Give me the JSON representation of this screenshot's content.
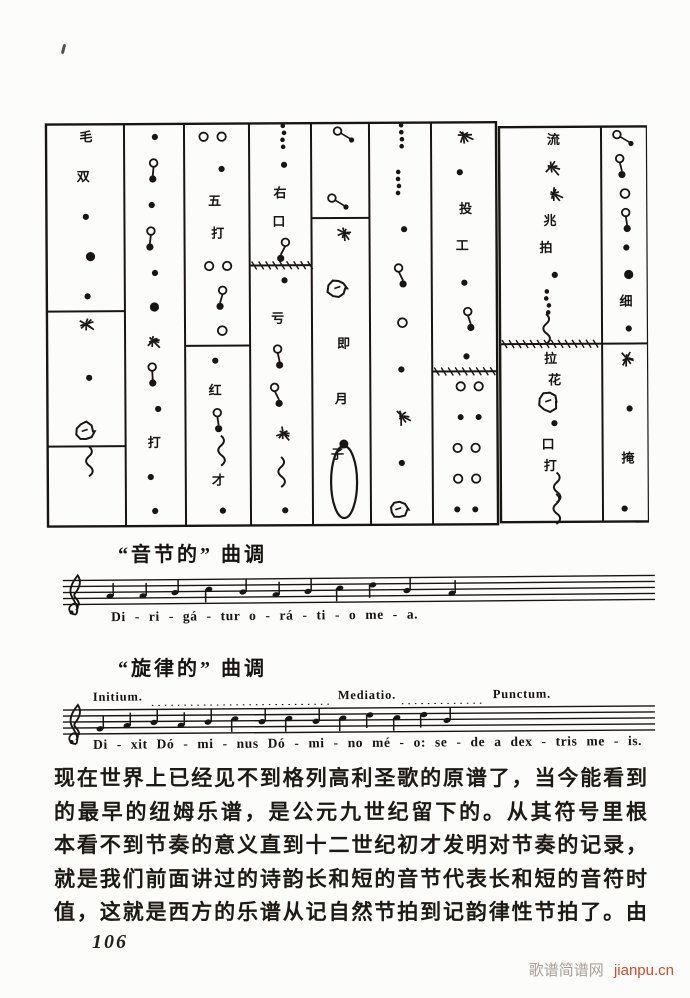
{
  "captions": {
    "syllabic": "“音节的” 曲调",
    "melodic": "“旋律的” 曲调"
  },
  "staff1": {
    "lyrics": "Di - ri - gá - tur  o - rá - ti - o  me - a."
  },
  "staff2": {
    "label_initium": "Initium.",
    "label_mediatio": "Mediatio.",
    "label_punctum": "Punctum.",
    "lyrics": "Di - xit  Dó - mi - nus  Dó - mi - no  mé - o:  se - de  a  dex - tris  me - is."
  },
  "paragraph": {
    "lines": [
      "现在世界上已经见不到格列高利圣歌的原谱了，当今能看到",
      "的最早的纽姆乐谱，是公元九世纪留下的。从其符号里根",
      "本看不到节奏的意义直到十二世纪初才发明对节奏的记录，",
      "就是我们前面讲过的诗韵长和短的音节代表长和短的音符时",
      "值，这就是西方的乐谱从记自然节拍到记韵律性节拍了。由"
    ]
  },
  "page_number": "106",
  "watermark": {
    "site_name": "歌谱简谱网",
    "site_url": "jianpu.cn",
    "url_color": "#cb4e28",
    "name_color": "#a79e96"
  },
  "figure": {
    "marks": [
      "毛",
      "双",
      "五",
      "打",
      "红",
      "才",
      "右",
      "口",
      "即",
      "月",
      "子",
      "拉",
      "花",
      "投",
      "工",
      "兆",
      "拍",
      "招",
      "掩",
      "流",
      "亏",
      "细",
      "唱"
    ],
    "ink_color": "#181512"
  }
}
